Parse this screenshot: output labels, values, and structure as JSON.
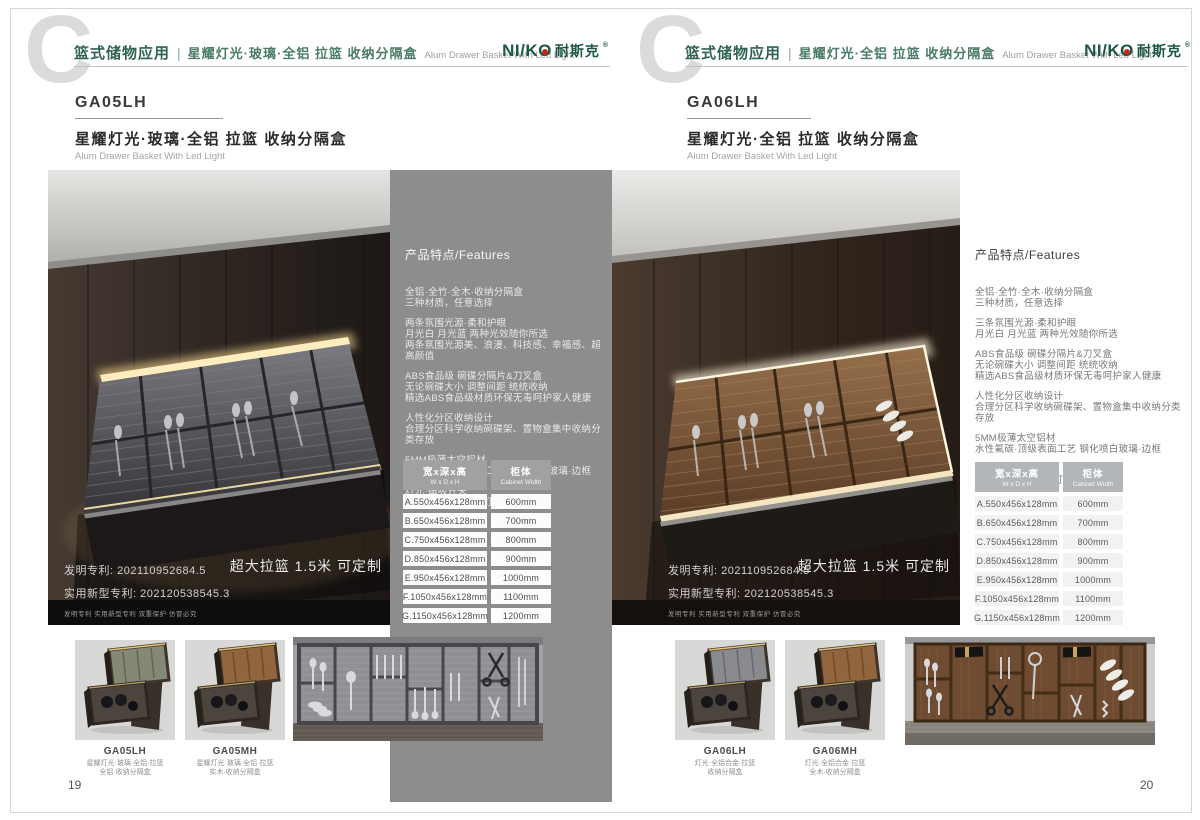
{
  "colors": {
    "brand_green": "#1c5743",
    "brand_red": "#c4281c",
    "panel_gray": "#8d8d8d",
    "led_accent": "#ffe9b8"
  },
  "brand": {
    "latin_prefix": "NI/K",
    "latin_o": "O",
    "cjk": "耐斯克",
    "reg": "®"
  },
  "shared": {
    "header_en": "Alum Drawer Basket With Led Light",
    "features_title": "产品特点/Features",
    "patent_line1": "发明专利: 202110952684.5",
    "patent_line2": "实用新型专利: 202120538545.3",
    "patent_line3": "发明专利 实用新型专利 双重保护 仿冒必究",
    "badge": "超大拉篮 1.5米 可定制",
    "table": {
      "h1_zh": "宽x深x高",
      "h1_en": "W x D x H",
      "h2_zh": "柜体",
      "h2_en": "Cabinet Width",
      "rows": [
        {
          "size": "A.550x456x128mm",
          "cabinet": "600mm"
        },
        {
          "size": "B.650x456x128mm",
          "cabinet": "700mm"
        },
        {
          "size": "C.750x456x128mm",
          "cabinet": "800mm"
        },
        {
          "size": "D.850x456x128mm",
          "cabinet": "900mm"
        },
        {
          "size": "E.950x456x128mm",
          "cabinet": "1000mm"
        },
        {
          "size": "F.1050x456x128mm",
          "cabinet": "1100mm"
        },
        {
          "size": "G.1150x456x128mm",
          "cabinet": "1200mm"
        }
      ]
    }
  },
  "left_page": {
    "watermark": "C",
    "header_category": "篮式储物应用",
    "header_sep": "|",
    "header_product": "星耀灯光·玻璃·全铝 拉篮 收纳分隔盒",
    "product_code": "GA05LH",
    "product_title": "星耀灯光·玻璃·全铝 拉篮 收纳分隔盒",
    "product_subtitle": "Alum Drawer Basket With Led Light",
    "features_groups": [
      [
        "全铝·全竹·全木·收纳分隔盒",
        "三种材质，任意选择"
      ],
      [
        "两条氛围光源·柔和护眼",
        "月光白 月光蓝 两种光效随你所选",
        "两条氛围光源美、浪漫、科技感、幸福感、超高颜值"
      ],
      [
        "ABS食品级 碗碟分隔片&刀叉盒",
        "无论碗碟大小 调整间距 统统收纳",
        "精选ABS食品级材质环保无毒呵护家人健康"
      ],
      [
        "人性化分区收纳设计",
        "合理分区科学收纳碗碟架、置物盒集中收纳分类存放"
      ],
      [
        "5MM极薄太空铝材",
        "水性氟碳·顶级表面工艺 钢化喷白玻璃·边框"
      ],
      [
        "灯光·磁吸开关",
        "拉出·灯亮起 关闭·灯自熄"
      ]
    ],
    "thumbs": [
      {
        "code": "GA05LH",
        "caption": [
          "星耀灯光·玻璃·全铝·拉篮",
          "全铝·收纳分隔盒"
        ]
      },
      {
        "code": "GA05MH",
        "caption": [
          "星耀灯光·玻璃·全铝·拉篮",
          "实木·收纳分隔盒"
        ]
      }
    ],
    "page_number": "19"
  },
  "right_page": {
    "watermark": "C",
    "header_category": "篮式储物应用",
    "header_sep": "|",
    "header_product": "星耀灯光·全铝 拉篮 收纳分隔盒",
    "product_code": "GA06LH",
    "product_title": "星耀灯光·全铝 拉篮 收纳分隔盒",
    "product_subtitle": "Alum Drawer Basket With Led Light",
    "features_groups": [
      [
        "全铝·全竹·全木·收纳分隔盒",
        "三种材质，任意选择"
      ],
      [
        "三条氛围光源·柔和护眼",
        "月光白 月光蓝 两种光效随你所选"
      ],
      [
        "ABS食品级 碗碟分隔片&刀叉盒",
        "无论碗碟大小 调整间距 统统收纳",
        "精选ABS食品级材质环保无毒呵护家人健康"
      ],
      [
        "人性化分区收纳设计",
        "合理分区科学收纳碗碟架、置物盒集中收纳分类存放"
      ],
      [
        "5MM极薄太空铝材",
        "水性氟碳·顶级表面工艺 钢化喷白玻璃·边框"
      ],
      [
        "灯光·磁吸开关",
        "拉出·灯亮起 关闭·灯自熄"
      ]
    ],
    "thumbs": [
      {
        "code": "GA06LH",
        "caption": [
          "灯光·全铝合金·拉篮",
          "收纳分隔盒"
        ]
      },
      {
        "code": "GA06MH",
        "caption": [
          "灯光·全铝合金·拉篮",
          "全木·收纳分隔盒"
        ]
      }
    ],
    "page_number": "20"
  }
}
